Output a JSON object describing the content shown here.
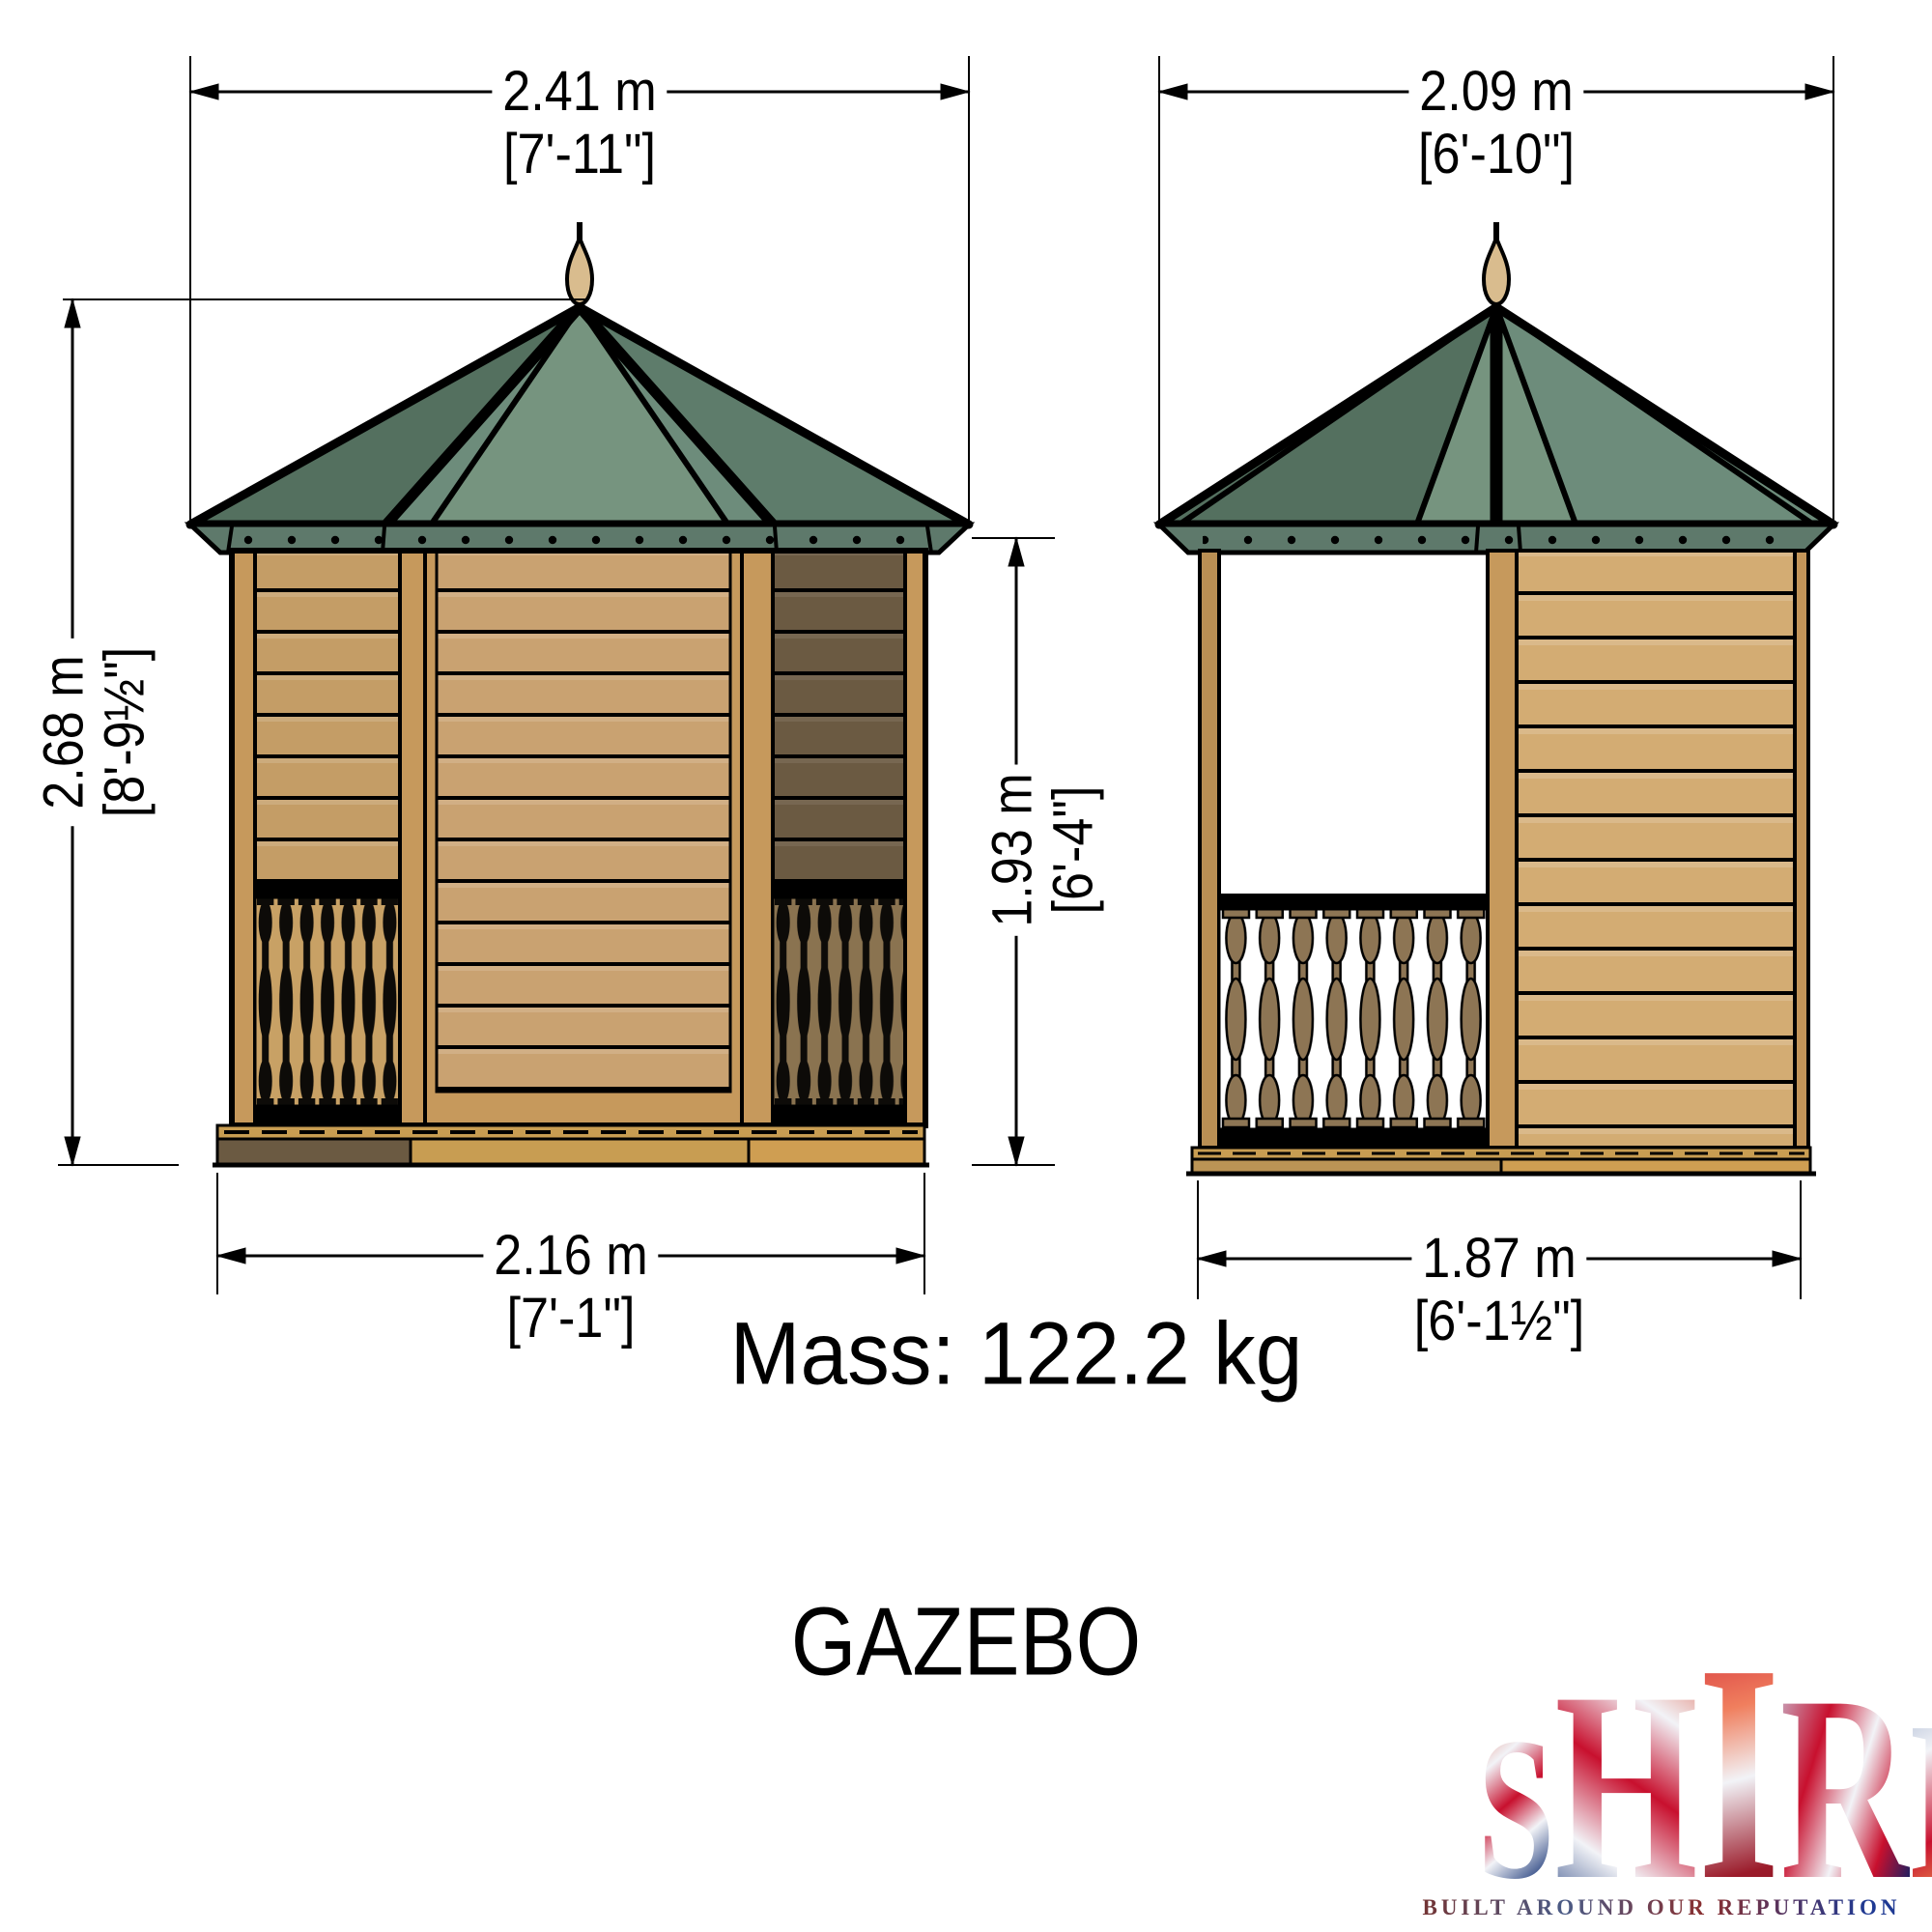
{
  "title": "GAZEBO",
  "mass_label": "Mass: 122.2 kg",
  "dims": {
    "front_roof_width": {
      "metric": "2.41 m",
      "imperial": "[7'-11\"]"
    },
    "side_roof_width": {
      "metric": "2.09 m",
      "imperial": "[6'-10\"]"
    },
    "overall_height": {
      "metric": "2.68 m",
      "imperial": "[8'-9½\"]"
    },
    "eaves_height": {
      "metric": "1.93 m",
      "imperial": "[6'-4\"]"
    },
    "front_base_width": {
      "metric": "2.16 m",
      "imperial": "[7'-1\"]"
    },
    "side_base_width": {
      "metric": "1.87 m",
      "imperial": "[6'-1½\"]"
    }
  },
  "logo": {
    "letters": [
      "S",
      "H",
      "I",
      "R",
      "E"
    ],
    "tagline": "BUILT AROUND OUR REPUTATION"
  },
  "colors": {
    "roof_green": "#6d8c7b",
    "roof_green_dark": "#54705f",
    "roof_green_light": "#76947f",
    "fascia_green": "#5e796b",
    "wood_tan": "#c6995c",
    "clad_light": "#c49d66",
    "clad_center": "#c9a271",
    "clad_dark": "#6b5a42",
    "clad_side": "#d3ac73",
    "baluster_bg": "#c8a165",
    "baluster_bg_dark": "#8a7350",
    "baluster_brown": "#8d7554",
    "base_tan": "#c89d52",
    "base_tan_light": "#cf9e52",
    "base_dark": "#6b5a42",
    "outline": "#000000"
  }
}
